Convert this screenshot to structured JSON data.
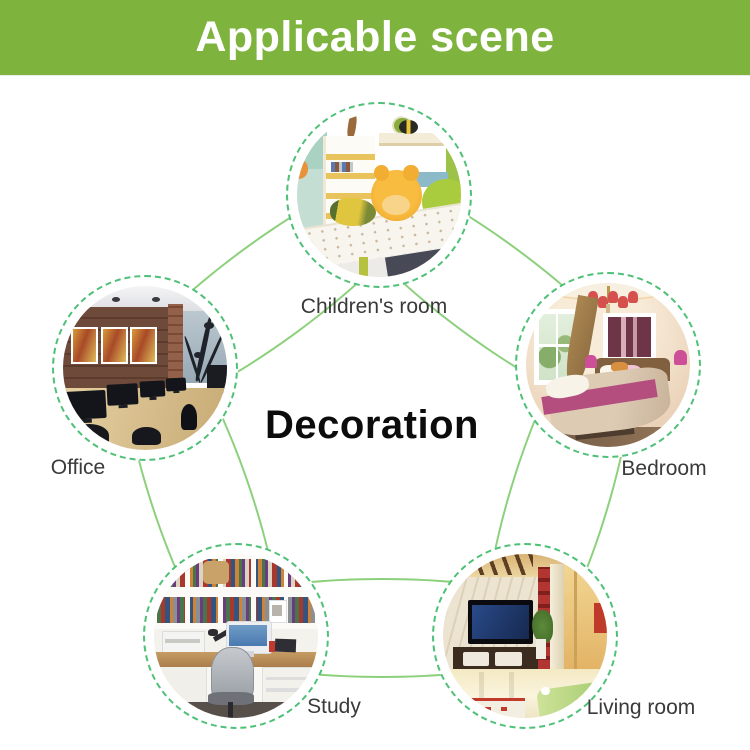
{
  "banner": {
    "title": "Applicable scene"
  },
  "center_label": "Decoration",
  "scenes": [
    {
      "id": "childrens-room",
      "label": "Children's room"
    },
    {
      "id": "office",
      "label": "Office"
    },
    {
      "id": "bedroom",
      "label": "Bedroom"
    },
    {
      "id": "study",
      "label": "Study"
    },
    {
      "id": "living-room",
      "label": "Living room"
    }
  ],
  "colors": {
    "banner_green": "#7eb43e",
    "connector_line_green": "#8cd07c",
    "dashed_ring_green": "#4fc077",
    "label_text": "#3a3a3a",
    "center_text": "#0c0c0c"
  }
}
